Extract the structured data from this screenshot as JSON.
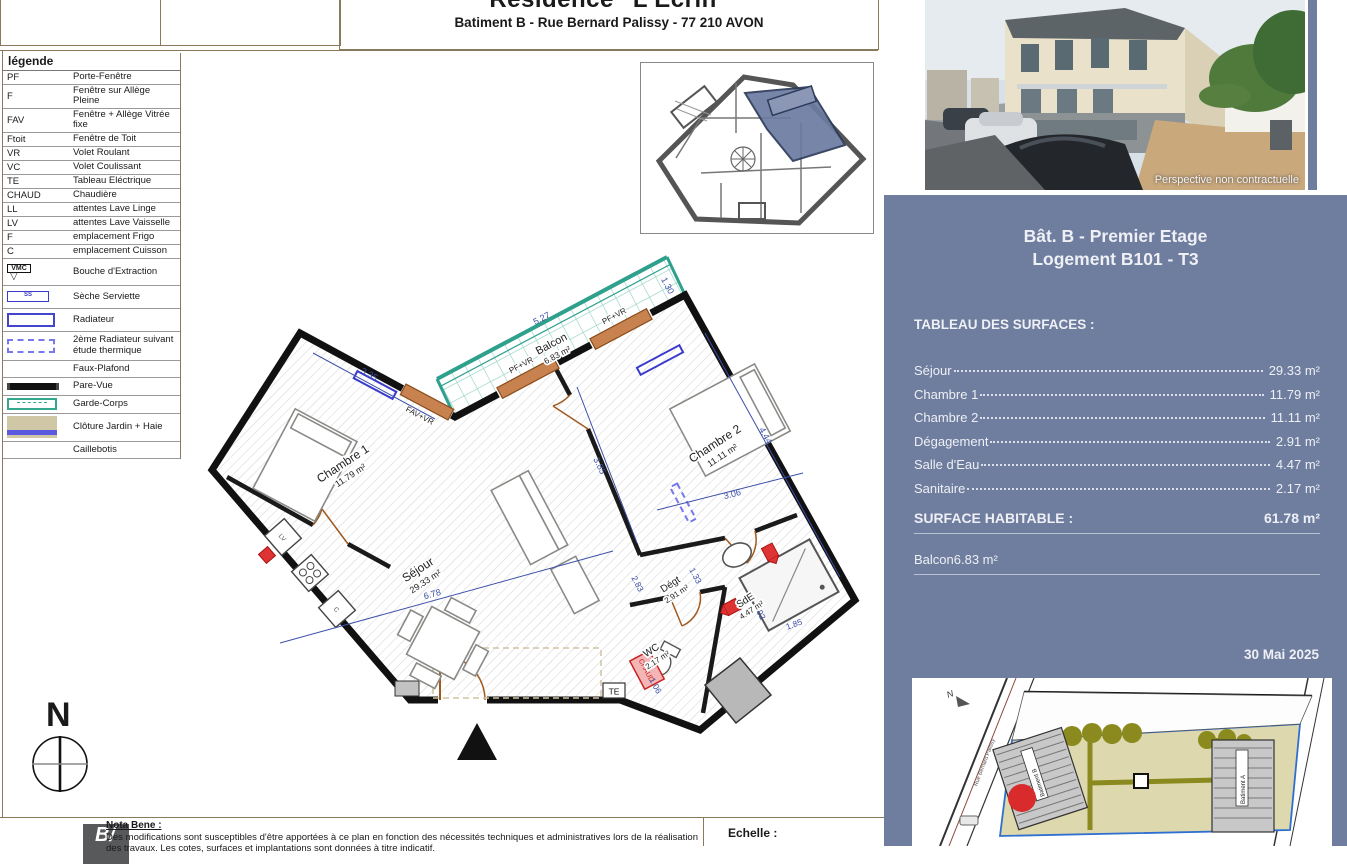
{
  "header": {
    "title": "Résidence \"L'Ecrin\"",
    "subtitle": "Batiment B - Rue Bernard Palissy - 77 210 AVON"
  },
  "legend": {
    "title": "légende",
    "items": [
      {
        "abbr": "PF",
        "label": "Porte-Fenêtre"
      },
      {
        "abbr": "F",
        "label": "Fenêtre sur Allège Pleine"
      },
      {
        "abbr": "FAV",
        "label": "Fenêtre + Allège Vitrée fixe"
      },
      {
        "abbr": "Ftoit",
        "label": "Fenêtre de Toit"
      },
      {
        "abbr": "VR",
        "label": "Volet Roulant"
      },
      {
        "abbr": "VC",
        "label": "Volet Coulissant"
      },
      {
        "abbr": "TE",
        "label": "Tableau Eléctrique"
      },
      {
        "abbr": "CHAUD",
        "label": "Chaudière"
      },
      {
        "abbr": "LL",
        "label": "attentes Lave Linge"
      },
      {
        "abbr": "LV",
        "label": "attentes Lave Vaisselle"
      },
      {
        "abbr": "F",
        "label": "emplacement Frigo"
      },
      {
        "abbr": "C",
        "label": "emplacement Cuisson"
      },
      {
        "abbr": "VMC",
        "label": "Bouche d'Extraction"
      },
      {
        "abbr": "SS",
        "label": "Sèche Serviette"
      },
      {
        "abbr": "",
        "label": "Radiateur"
      },
      {
        "abbr": "",
        "label": "2ème Radiateur suivant étude thermique"
      },
      {
        "abbr": "",
        "label": "Faux-Plafond"
      },
      {
        "abbr": "",
        "label": "Pare-Vue"
      },
      {
        "abbr": "",
        "label": "Garde-Corps"
      },
      {
        "abbr": "",
        "label": "Clôture Jardin + Haie"
      },
      {
        "abbr": "",
        "label": "Caillebotis"
      }
    ]
  },
  "photo": {
    "caption": "Perspective non contractuelle"
  },
  "panel": {
    "title_line1": "Bât. B - Premier Etage",
    "title_line2": "Logement B101 - T3",
    "table_title": "TABLEAU DES SURFACES :",
    "rows": [
      {
        "label": "Séjour",
        "value": "29.33 m²"
      },
      {
        "label": "Chambre 1",
        "value": "11.79 m²"
      },
      {
        "label": "Chambre 2",
        "value": "11.11 m²"
      },
      {
        "label": "Dégagement",
        "value": "2.91 m²"
      },
      {
        "label": "Salle d'Eau",
        "value": "4.47 m²"
      },
      {
        "label": "Sanitaire",
        "value": "2.17 m²"
      }
    ],
    "total_label": "SURFACE HABITABLE :",
    "total_value": "61.78 m²",
    "balcony_label": "Balcon",
    "balcony_value": "6.83 m²",
    "date": "30 Mai 2025"
  },
  "site_plan": {
    "building_b": "Batiment B",
    "building_a": "Batiment A",
    "street": "Rue Bernard Palissy",
    "north": "N"
  },
  "plan": {
    "rooms": [
      {
        "name": "Chambre 1",
        "area": "11.79 m²"
      },
      {
        "name": "Balcon",
        "area": "6.83 m²"
      },
      {
        "name": "Chambre 2",
        "area": "11.11 m²"
      },
      {
        "name": "Séjour",
        "area": "29.33 m²"
      },
      {
        "name": "Dégt",
        "area": "2.91 m²"
      },
      {
        "name": "WC",
        "area": "2.17 m²"
      },
      {
        "name": "SdE",
        "area": "4.47 m²"
      }
    ],
    "windows": [
      "FAV+VR",
      "PF+VR",
      "PF+VR"
    ],
    "dimensions": [
      "3.35",
      "5.27",
      "1.30",
      "6.78",
      "3.85",
      "3.06",
      "4.44",
      "1.33",
      "2.83",
      "1.06",
      "1.92",
      "1.85"
    ],
    "markers": {
      "chaud": "CHAUD",
      "te": "TE",
      "lv": "LV",
      "c": "C"
    }
  },
  "footer": {
    "north_label": "N",
    "logo": "B/",
    "nota_title": "Nota Bene :",
    "nota_text": "Des modifications sont susceptibles d'être apportées à ce plan en fonction des nécessités techniques et administratives lors de",
    "nota_text2": "la réalisation des travaux. Les cotes, surfaces et implantations sont données à titre indicatif.",
    "scale_label": "Echelle :"
  }
}
